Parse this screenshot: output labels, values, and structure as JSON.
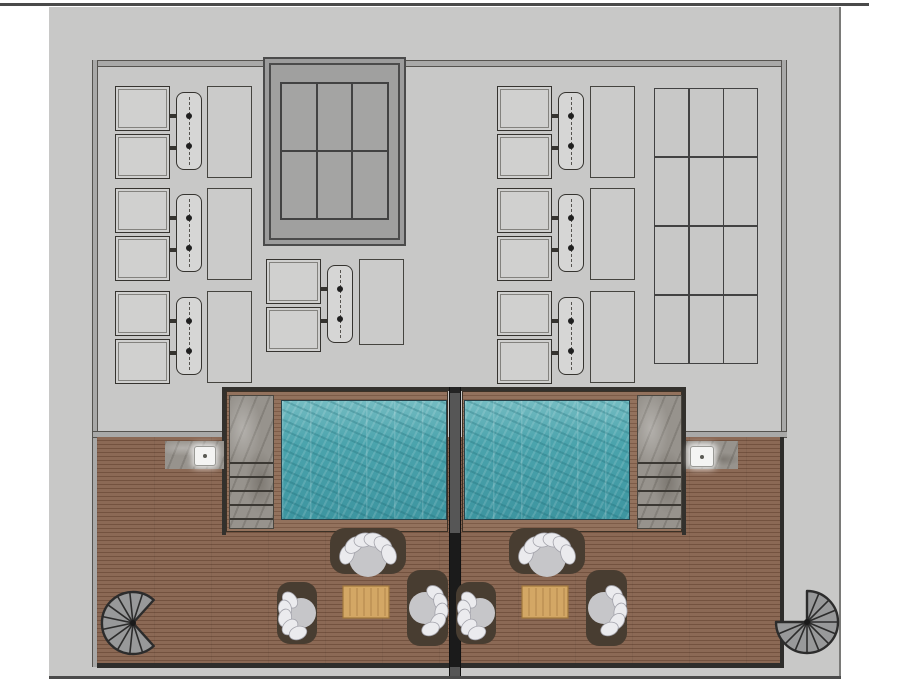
{
  "palette": {
    "page_bg": "#ffffff",
    "frame_line": "#4a4a4a",
    "concrete": "#c8c8c7",
    "wall_fill": "#a9a9a8",
    "wall_edge": "#55534f",
    "skylight_frame": "#4b4b4b",
    "skylight_fill": "#9c9c9c",
    "skylight_panel": "#a4a4a3",
    "grid_line": "#424242",
    "equip_fill": "#d0d0cf",
    "equip_edge": "#35332f",
    "pad_edge": "#45443f",
    "deck_wood": "#8b6955",
    "deck_plank": "#73523f",
    "coping_wood": "#93725d",
    "coping_plank": "#7d5c48",
    "water": "#4ba4ad",
    "water_deep": "#3d95a0",
    "water_light": "#74bcc2",
    "pool_edge": "#27424a",
    "stone": "#97938d",
    "stone_line": "#3b3833",
    "divider": "#565656",
    "divider_dark": "#1b1b1b",
    "trim_dark": "#2e2d2b",
    "stair_fill": "#98999a",
    "stair_edge": "#2c2c2c",
    "furniture_base": "#483d31",
    "seat": "#c6c6c9",
    "cushion": "#ebebee",
    "cushion_edge": "#a3a3ab",
    "table_wood": "#d3a765",
    "table_edge": "#a1773d"
  },
  "plan": {
    "equipment_clusters": [
      {
        "x": 115,
        "y": 86
      },
      {
        "x": 115,
        "y": 188
      },
      {
        "x": 115,
        "y": 291
      },
      {
        "x": 266,
        "y": 259
      },
      {
        "x": 497,
        "y": 86
      },
      {
        "x": 497,
        "y": 188
      },
      {
        "x": 497,
        "y": 291
      }
    ],
    "equipment_pads": [
      {
        "x": 207,
        "y": 86,
        "w": 45,
        "h": 92
      },
      {
        "x": 207,
        "y": 188,
        "w": 45,
        "h": 92
      },
      {
        "x": 207,
        "y": 291,
        "w": 45,
        "h": 92
      },
      {
        "x": 359,
        "y": 259,
        "w": 45,
        "h": 86
      },
      {
        "x": 590,
        "y": 86,
        "w": 45,
        "h": 92
      },
      {
        "x": 590,
        "y": 188,
        "w": 45,
        "h": 92
      },
      {
        "x": 590,
        "y": 291,
        "w": 45,
        "h": 92
      }
    ],
    "skylight_grid": {
      "cols": 3,
      "rows": 2
    },
    "roof_grid": {
      "cols": 3,
      "rows": 4
    },
    "stairs": [
      {
        "cx": 133,
        "cy": 623,
        "r": 31,
        "solid_start": 48,
        "solid_sweep": 264,
        "treads": 10
      },
      {
        "cx": 807,
        "cy": 622,
        "r": 31,
        "solid_start": 270,
        "solid_sweep": 270,
        "treads": 11
      }
    ],
    "furniture_groups": [
      {
        "x": 277,
        "y": 528
      },
      {
        "x": 456,
        "y": 528
      }
    ]
  }
}
